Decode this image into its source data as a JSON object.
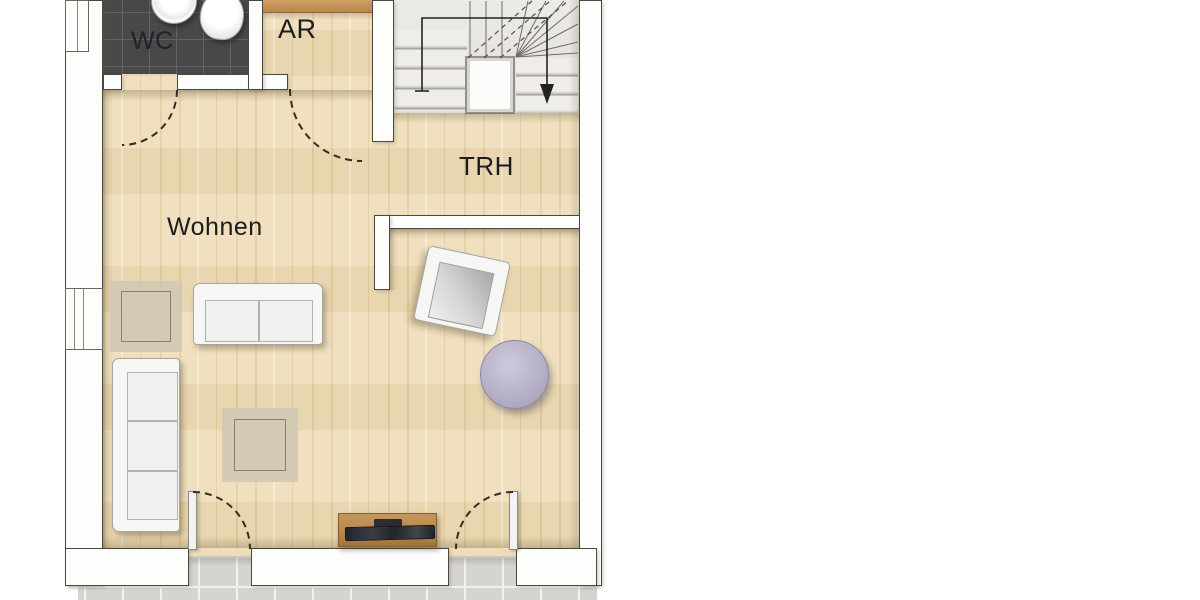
{
  "plan": {
    "type": "residential-floor-plan",
    "rooms": [
      {
        "id": "wc",
        "label": "WC",
        "floor": "dark-tile"
      },
      {
        "id": "ar",
        "label": "AR",
        "floor": "wood"
      },
      {
        "id": "trh",
        "label": "TRH",
        "floor": "wood"
      },
      {
        "id": "wohnen",
        "label": "Wohnen",
        "floor": "wood"
      }
    ],
    "stair": {
      "shape": "u-turn",
      "walk_line": true,
      "arrow_direction": "down"
    },
    "doors": [
      "wc-door",
      "ar-door",
      "trh-passage",
      "terrace-door-left",
      "terrace-door-right"
    ],
    "windows": [
      "window-top-left",
      "window-left"
    ],
    "furniture": [
      "washbasin",
      "toilet",
      "two-seat-sofa",
      "three-seat-sofa",
      "armchair",
      "round-side-table",
      "rug-small",
      "rug-large",
      "sideboard-with-tv",
      "terrace-tiles"
    ],
    "colors": {
      "wood": "#eeddb8",
      "wood_stripe": "#e3cd9f",
      "wall_fill": "#fdfdfc",
      "wall_line": "#4a4741",
      "wc_tile": "#48484b",
      "wc_grid": "#626267",
      "terrace": "#d6d4d1",
      "terrace_line": "#f2f1ee",
      "label_ink": "#1c1c1e",
      "rug": "#d2c9b5",
      "rug_line": "#7f796b",
      "sofa": "#f6f6f4",
      "sofa_line": "#a5a5a2",
      "cushion": "#f1f1ef",
      "table_fill": "#b4aec6",
      "sideboard": "#b8884e",
      "arc_ink": "#372c1d",
      "walk_ink": "#232323"
    }
  }
}
